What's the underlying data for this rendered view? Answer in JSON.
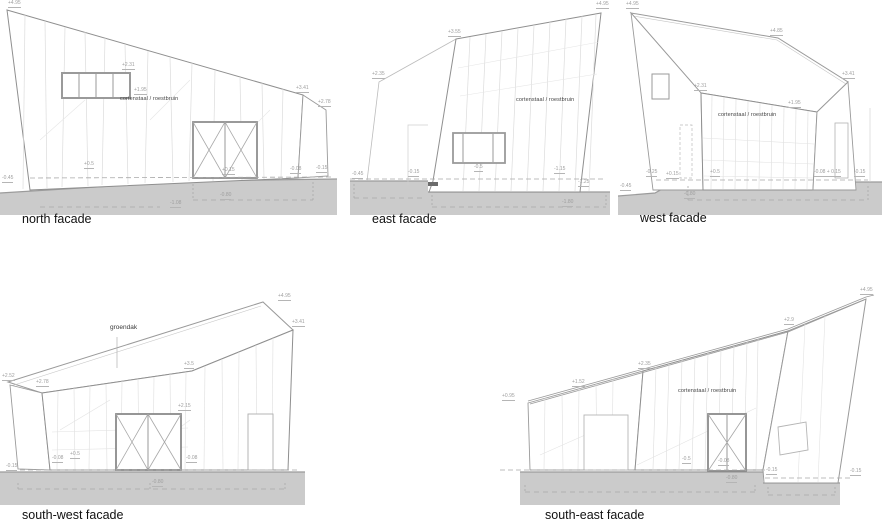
{
  "colors": {
    "ground_fill": "#cbcbcb",
    "ground_edge": "#9b9b9b",
    "outline_strong": "#8f8f8f",
    "outline_light": "#9a9a9a",
    "seam_faint": "#dcdcdc",
    "dashed_line": "#a8a8a8",
    "dim_text": "#9f9f9f",
    "label_text": "#444444",
    "title_text": "#111111",
    "dark_patch": "#6b6b6b"
  },
  "facades": {
    "north": {
      "title": "north facade",
      "material_label": "cortenstaal / roestbruin",
      "dims": [
        {
          "t": "+4.95",
          "x": 8,
          "y": 1
        },
        {
          "t": "+3.41",
          "x": 296,
          "y": 86
        },
        {
          "t": "+2.78",
          "x": 318,
          "y": 100
        },
        {
          "t": "+2.31",
          "x": 122,
          "y": 63
        },
        {
          "t": "+1.95",
          "x": 134,
          "y": 88
        },
        {
          "t": "+0.5",
          "x": 84,
          "y": 162
        },
        {
          "t": "+0.15",
          "x": 222,
          "y": 168
        },
        {
          "t": "-0.08",
          "x": 290,
          "y": 167
        },
        {
          "t": "-0.15",
          "x": 316,
          "y": 166
        },
        {
          "t": "-0.45",
          "x": 2,
          "y": 176
        },
        {
          "t": "-0.80",
          "x": 220,
          "y": 193
        },
        {
          "t": "-1.08",
          "x": 170,
          "y": 201
        }
      ]
    },
    "east": {
      "title": "east facade",
      "material_label": "cortenstaal / roestbruin",
      "dims": [
        {
          "t": "+4.95",
          "x": 246,
          "y": 2
        },
        {
          "t": "+3.55",
          "x": 98,
          "y": 30
        },
        {
          "t": "+2.35",
          "x": 22,
          "y": 72
        },
        {
          "t": "-0.45",
          "x": 2,
          "y": 172
        },
        {
          "t": "-0.15",
          "x": 58,
          "y": 170
        },
        {
          "t": "-0.5",
          "x": 124,
          "y": 165
        },
        {
          "t": "-1.15",
          "x": 204,
          "y": 167
        },
        {
          "t": "-1.25",
          "x": 228,
          "y": 180
        },
        {
          "t": "-1.80",
          "x": 212,
          "y": 200
        }
      ]
    },
    "west": {
      "title": "west facade",
      "material_label": "cortenstaal / roestbruin",
      "dims": [
        {
          "t": "+4.95",
          "x": 8,
          "y": 2
        },
        {
          "t": "+4.85",
          "x": 152,
          "y": 29
        },
        {
          "t": "+3.41",
          "x": 224,
          "y": 72
        },
        {
          "t": "+2.31",
          "x": 76,
          "y": 84
        },
        {
          "t": "+1.95",
          "x": 170,
          "y": 101
        },
        {
          "t": "+0.5",
          "x": 92,
          "y": 170
        },
        {
          "t": "+0.15",
          "x": 48,
          "y": 172
        },
        {
          "t": "-0.25",
          "x": 28,
          "y": 170
        },
        {
          "t": "-0.45",
          "x": 2,
          "y": 184
        },
        {
          "t": "-0.08 + 0.15",
          "x": 196,
          "y": 170
        },
        {
          "t": "-0.15",
          "x": 236,
          "y": 170
        },
        {
          "t": "-0.80",
          "x": 66,
          "y": 192
        }
      ]
    },
    "southwest": {
      "title": "south-west facade",
      "roof_label": "groendak",
      "dims": [
        {
          "t": "+4.95",
          "x": 278,
          "y": 14
        },
        {
          "t": "+3.41",
          "x": 292,
          "y": 40
        },
        {
          "t": "+3.5",
          "x": 184,
          "y": 82
        },
        {
          "t": "+2.78",
          "x": 36,
          "y": 100
        },
        {
          "t": "+2.52",
          "x": 2,
          "y": 94
        },
        {
          "t": "+2.15",
          "x": 178,
          "y": 124
        },
        {
          "t": "+0.5",
          "x": 70,
          "y": 172
        },
        {
          "t": "-0.08",
          "x": 52,
          "y": 176
        },
        {
          "t": "-0.08",
          "x": 186,
          "y": 176
        },
        {
          "t": "-0.80",
          "x": 152,
          "y": 200
        },
        {
          "t": "-0.15",
          "x": 6,
          "y": 184
        }
      ]
    },
    "southeast": {
      "title": "south-east facade",
      "material_label": "cortenstaal / roestbruin",
      "dims": [
        {
          "t": "+0.95",
          "x": 2,
          "y": 114
        },
        {
          "t": "+1.52",
          "x": 72,
          "y": 100
        },
        {
          "t": "+2.35",
          "x": 138,
          "y": 82
        },
        {
          "t": "+2.9",
          "x": 284,
          "y": 38
        },
        {
          "t": "+4.95",
          "x": 360,
          "y": 8
        },
        {
          "t": "-0.5",
          "x": 182,
          "y": 177
        },
        {
          "t": "-0.08",
          "x": 218,
          "y": 179
        },
        {
          "t": "-0.80",
          "x": 226,
          "y": 196
        },
        {
          "t": "-0.15",
          "x": 266,
          "y": 188
        },
        {
          "t": "-0.15",
          "x": 350,
          "y": 189
        }
      ]
    }
  }
}
